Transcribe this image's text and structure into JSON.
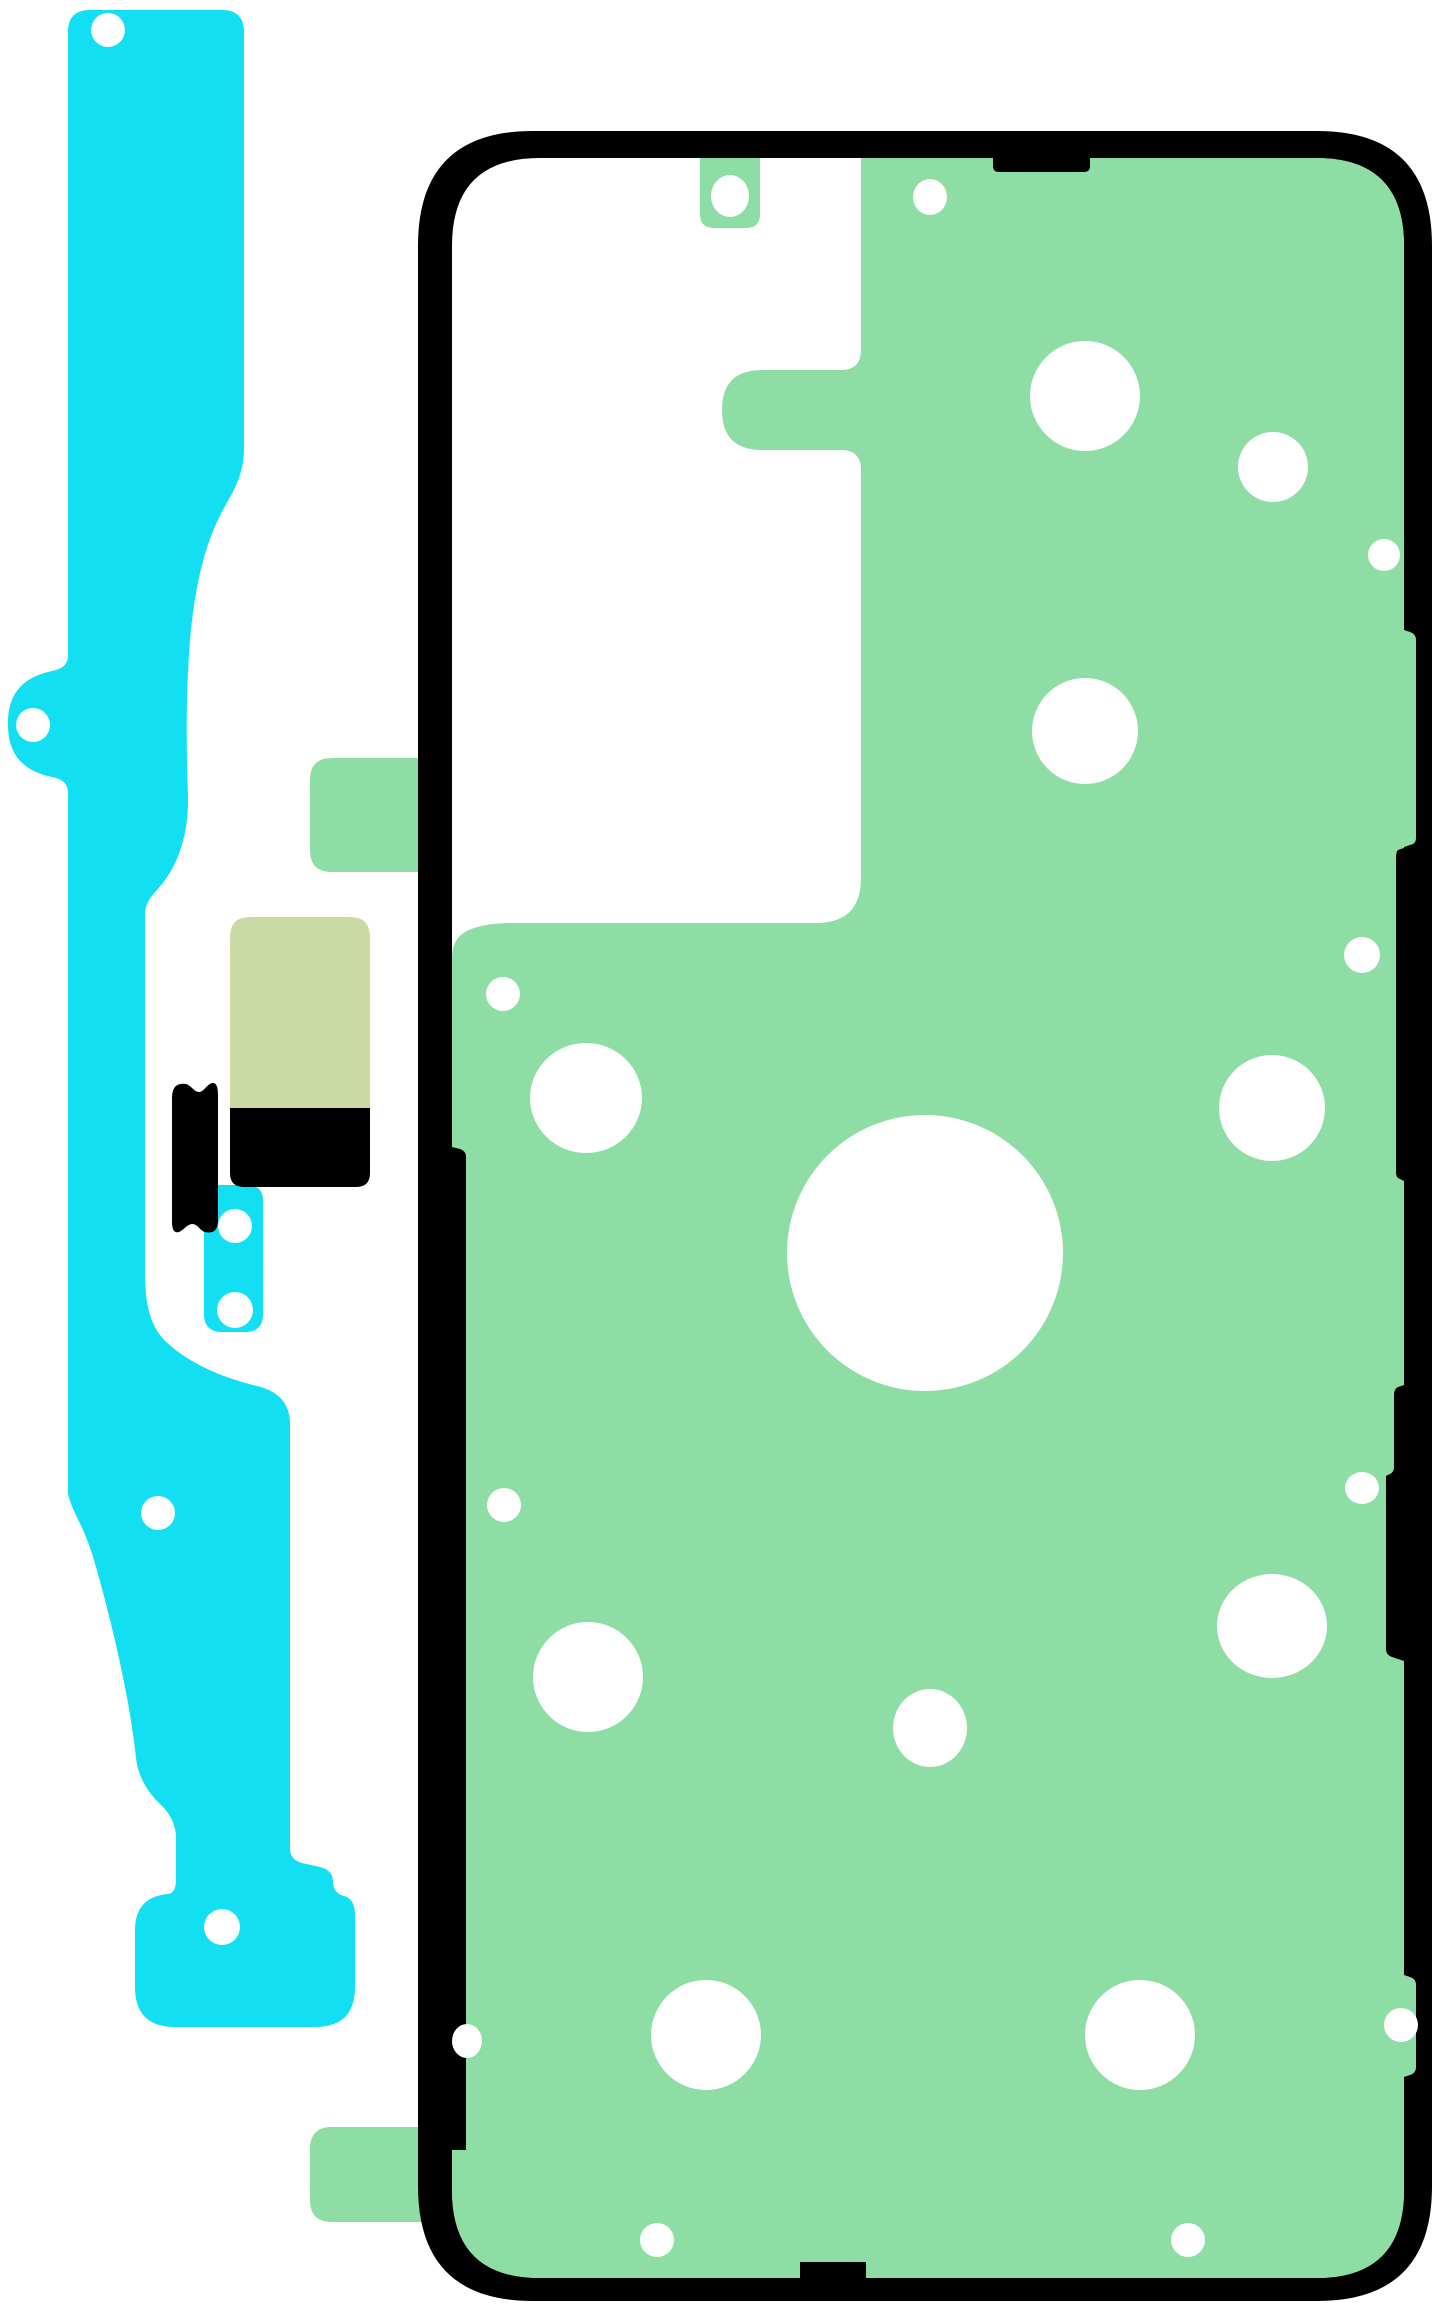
{
  "illustration": {
    "description": "Adhesive tape rework kit diagram: cyan side adhesive strip, small cyan connector pad, khaki pad, black pads, and phone-shaped back-cover adhesive sheet (green) with black outer gasket frame and white punch-out holes",
    "canvas": {
      "width": 1445,
      "height": 2310
    }
  },
  "colors": {
    "background": "#ffffff",
    "cyan": "#12dff2",
    "green": "#8edda4",
    "khaki": "#cbdaa3",
    "black": "#000000",
    "white": "#ffffff"
  },
  "parts": [
    {
      "name": "cyan-side-strip",
      "fill": "cyan",
      "d": "M 90,10 L 222,10 Q 244,10 244,32 L 244,448 C 244,475 233,492 224,508 C 208,537 196,575 190,640 C 186,690 186,745 188,795 C 189,830 180,862 162,884 C 150,898 145,903 145,915 L 145,1272 C 145,1312 153,1332 172,1347 C 196,1367 228,1379 257,1386 Q 290,1394 290,1424 L 290,1848 Q 290,1860 302,1863 L 320,1867 Q 333,1870 333,1882 Q 333,1893 344,1896 Q 355,1899 355,1915 L 355,1987 Q 355,2027 315,2027 L 175,2027 Q 135,2027 135,1987 L 135,1930 Q 135,1897 168,1894 Q 176,1893 176,1880 L 176,1838 Q 176,1818 158,1802 C 146,1790 138,1775 136,1758 C 130,1700 112,1622 94,1560 C 84,1526 72,1512 68,1494 L 68,792 Q 68,780 52,777 C 24,771 8,756 8,724 C 8,692 24,677 52,671 Q 68,668 68,656 L 68,32 Q 68,10 90,10 Z"
    },
    {
      "name": "cyan-connector-pad",
      "fill": "cyan",
      "d": "M 220,1185 L 247,1185 Q 263,1185 263,1201 L 263,1314 Q 263,1332 245,1332 L 222,1332 Q 204,1332 204,1314 L 204,1201 Q 204,1185 220,1185 Z"
    },
    {
      "name": "khaki-pad",
      "fill": "khaki",
      "d": "M 250,917 L 350,917 Q 370,917 370,937 L 370,1108 L 230,1108 L 230,937 Q 230,917 250,917 Z"
    },
    {
      "name": "black-pad",
      "fill": "black",
      "d": "M 230,1108 L 370,1108 L 370,1173 Q 370,1187 356,1187 L 244,1187 Q 230,1187 230,1173 Z"
    },
    {
      "name": "black-clip",
      "fill": "black",
      "d": "M 172,1098 Q 172,1082 186,1084 C 192,1086 194,1092 199,1092 C 204,1092 206,1085 212,1083 Q 218,1082 218,1095 L 218,1220 Q 218,1235 205,1232 C 199,1230 198,1224 192,1224 C 186,1225 184,1230 179,1232 Q 172,1234 172,1222 Z"
    },
    {
      "name": "sheet-left-tab",
      "fill": "green",
      "d": "M 332,758 L 445,758 L 445,872 L 332,872 Q 310,872 310,850 L 310,780 Q 310,758 332,758 Z"
    },
    {
      "name": "sheet-bottom-tab",
      "fill": "green",
      "d": "M 332,2127 L 445,2127 L 445,2222 L 332,2222 Q 310,2222 310,2200 L 310,2149 Q 310,2127 332,2127 Z"
    },
    {
      "name": "frame-outer",
      "fill": "black",
      "d": "M 533,131 L 1317,131 Q 1432,131 1432,246 L 1432,2186 Q 1432,2301 1317,2301 L 533,2301 Q 418,2301 418,2186 L 418,246 Q 418,131 533,131 Z"
    },
    {
      "name": "frame-inner",
      "fill": "white",
      "d": "M 540,158 L 1316,158 Q 1404,158 1404,246 L 1404,2190 Q 1404,2278 1316,2278 L 540,2278 Q 452,2278 452,2190 L 452,246 Q 452,158 540,158 Z"
    },
    {
      "name": "main-adhesive-sheet",
      "fill": "green",
      "d": "M 861,158 L 1316,158 Q 1404,158 1404,246 L 1404,2190 Q 1404,2278 1316,2278 L 540,2278 Q 452,2278 452,2190 L 452,957 Q 452,935 474,928 Q 490,923 510,923 L 816,923 Q 861,923 861,878 L 861,470 Q 861,450 841,450 L 762,450 Q 722,450 722,410 Q 722,370 762,370 L 841,370 Q 861,370 861,350 Z"
    },
    {
      "name": "sheet-right-bulge-upper",
      "fill": "green",
      "d": "M 1404,630 L 1410,632 Q 1416,634 1416,640 L 1416,838 Q 1416,844 1410,845 L 1404,847 Z"
    },
    {
      "name": "sheet-right-bulge-lower",
      "fill": "green",
      "d": "M 1404,1975 L 1410,1977 Q 1416,1979 1416,1985 L 1416,2067 Q 1416,2073 1410,2075 L 1404,2077 Z"
    },
    {
      "name": "sheet-top-tab",
      "fill": "green",
      "d": "M 700,158 L 760,158 L 760,214 Q 760,228 746,228 L 714,228 Q 700,228 700,214 Z"
    },
    {
      "name": "frame-notch-top",
      "fill": "black",
      "d": "M 993,158 L 1090,158 L 1090,166 Q 1090,172 1084,172 L 999,172 Q 993,172 993,166 Z"
    },
    {
      "name": "frame-notch-left",
      "fill": "black",
      "d": "M 452,1147 L 460,1149 Q 466,1151 466,1157 L 466,2150 L 452,2150 Z"
    },
    {
      "name": "frame-notch-right-a",
      "fill": "black",
      "d": "M 1404,848 L 1398,850 Q 1396,852 1396,858 L 1396,1172 Q 1396,1178 1400,1179 L 1404,1181 Z"
    },
    {
      "name": "frame-notch-right-b",
      "fill": "black",
      "d": "M 1404,1385 L 1398,1387 Q 1394,1389 1394,1395 L 1394,1467 Q 1394,1472 1390,1474 L 1386,1476 L 1386,1649 Q 1386,1655 1392,1657 L 1404,1661 Z"
    },
    {
      "name": "frame-notch-bottom",
      "fill": "black",
      "d": "M 800,2262 L 866,2262 L 866,2278 L 800,2278 Z"
    }
  ],
  "holes": [
    {
      "name": "hole-strip-top",
      "cx": 108,
      "cy": 30,
      "rx": 17,
      "ry": 17
    },
    {
      "name": "hole-strip-ear",
      "cx": 33,
      "cy": 725,
      "rx": 17,
      "ry": 17
    },
    {
      "name": "hole-strip-mid",
      "cx": 158,
      "cy": 1513,
      "rx": 17,
      "ry": 17
    },
    {
      "name": "hole-strip-foot",
      "cx": 222,
      "cy": 1927,
      "rx": 18,
      "ry": 18
    },
    {
      "name": "hole-connector-upper",
      "cx": 235,
      "cy": 1226,
      "rx": 17,
      "ry": 17
    },
    {
      "name": "hole-connector-lower",
      "cx": 235,
      "cy": 1310,
      "rx": 18,
      "ry": 18
    },
    {
      "name": "hole-top-tab",
      "cx": 730,
      "cy": 196,
      "rx": 19,
      "ry": 21
    },
    {
      "name": "hole-sheet-1",
      "cx": 930,
      "cy": 197,
      "rx": 17,
      "ry": 18
    },
    {
      "name": "hole-sheet-2",
      "cx": 1085,
      "cy": 396,
      "rx": 55,
      "ry": 55
    },
    {
      "name": "hole-sheet-3",
      "cx": 1273,
      "cy": 467,
      "rx": 35,
      "ry": 35
    },
    {
      "name": "hole-sheet-4",
      "cx": 1384,
      "cy": 555,
      "rx": 16,
      "ry": 16
    },
    {
      "name": "hole-sheet-5",
      "cx": 1085,
      "cy": 731,
      "rx": 53,
      "ry": 53
    },
    {
      "name": "hole-sheet-6",
      "cx": 1362,
      "cy": 955,
      "rx": 18,
      "ry": 18
    },
    {
      "name": "hole-sheet-7",
      "cx": 503,
      "cy": 994,
      "rx": 17,
      "ry": 17
    },
    {
      "name": "hole-sheet-8",
      "cx": 586,
      "cy": 1098,
      "rx": 56,
      "ry": 55
    },
    {
      "name": "hole-sheet-9",
      "cx": 1272,
      "cy": 1108,
      "rx": 53,
      "ry": 53
    },
    {
      "name": "hole-sheet-center",
      "cx": 925,
      "cy": 1253,
      "rx": 138,
      "ry": 138
    },
    {
      "name": "hole-sheet-10",
      "cx": 1362,
      "cy": 1488,
      "rx": 17,
      "ry": 16
    },
    {
      "name": "hole-sheet-11",
      "cx": 504,
      "cy": 1505,
      "rx": 17,
      "ry": 17
    },
    {
      "name": "hole-sheet-12",
      "cx": 588,
      "cy": 1677,
      "rx": 55,
      "ry": 55
    },
    {
      "name": "hole-sheet-13",
      "cx": 930,
      "cy": 1728,
      "rx": 37,
      "ry": 39
    },
    {
      "name": "hole-sheet-14",
      "cx": 1272,
      "cy": 1626,
      "rx": 55,
      "ry": 52
    },
    {
      "name": "hole-sheet-15",
      "cx": 706,
      "cy": 2035,
      "rx": 55,
      "ry": 55
    },
    {
      "name": "hole-sheet-16",
      "cx": 1140,
      "cy": 2035,
      "rx": 55,
      "ry": 55
    },
    {
      "name": "hole-sheet-17",
      "cx": 467,
      "cy": 2041,
      "rx": 15,
      "ry": 17
    },
    {
      "name": "hole-sheet-18",
      "cx": 657,
      "cy": 2240,
      "rx": 17,
      "ry": 17
    },
    {
      "name": "hole-sheet-19",
      "cx": 1188,
      "cy": 2240,
      "rx": 17,
      "ry": 17
    },
    {
      "name": "hole-sheet-20",
      "cx": 1401,
      "cy": 2025,
      "rx": 17,
      "ry": 17
    }
  ]
}
